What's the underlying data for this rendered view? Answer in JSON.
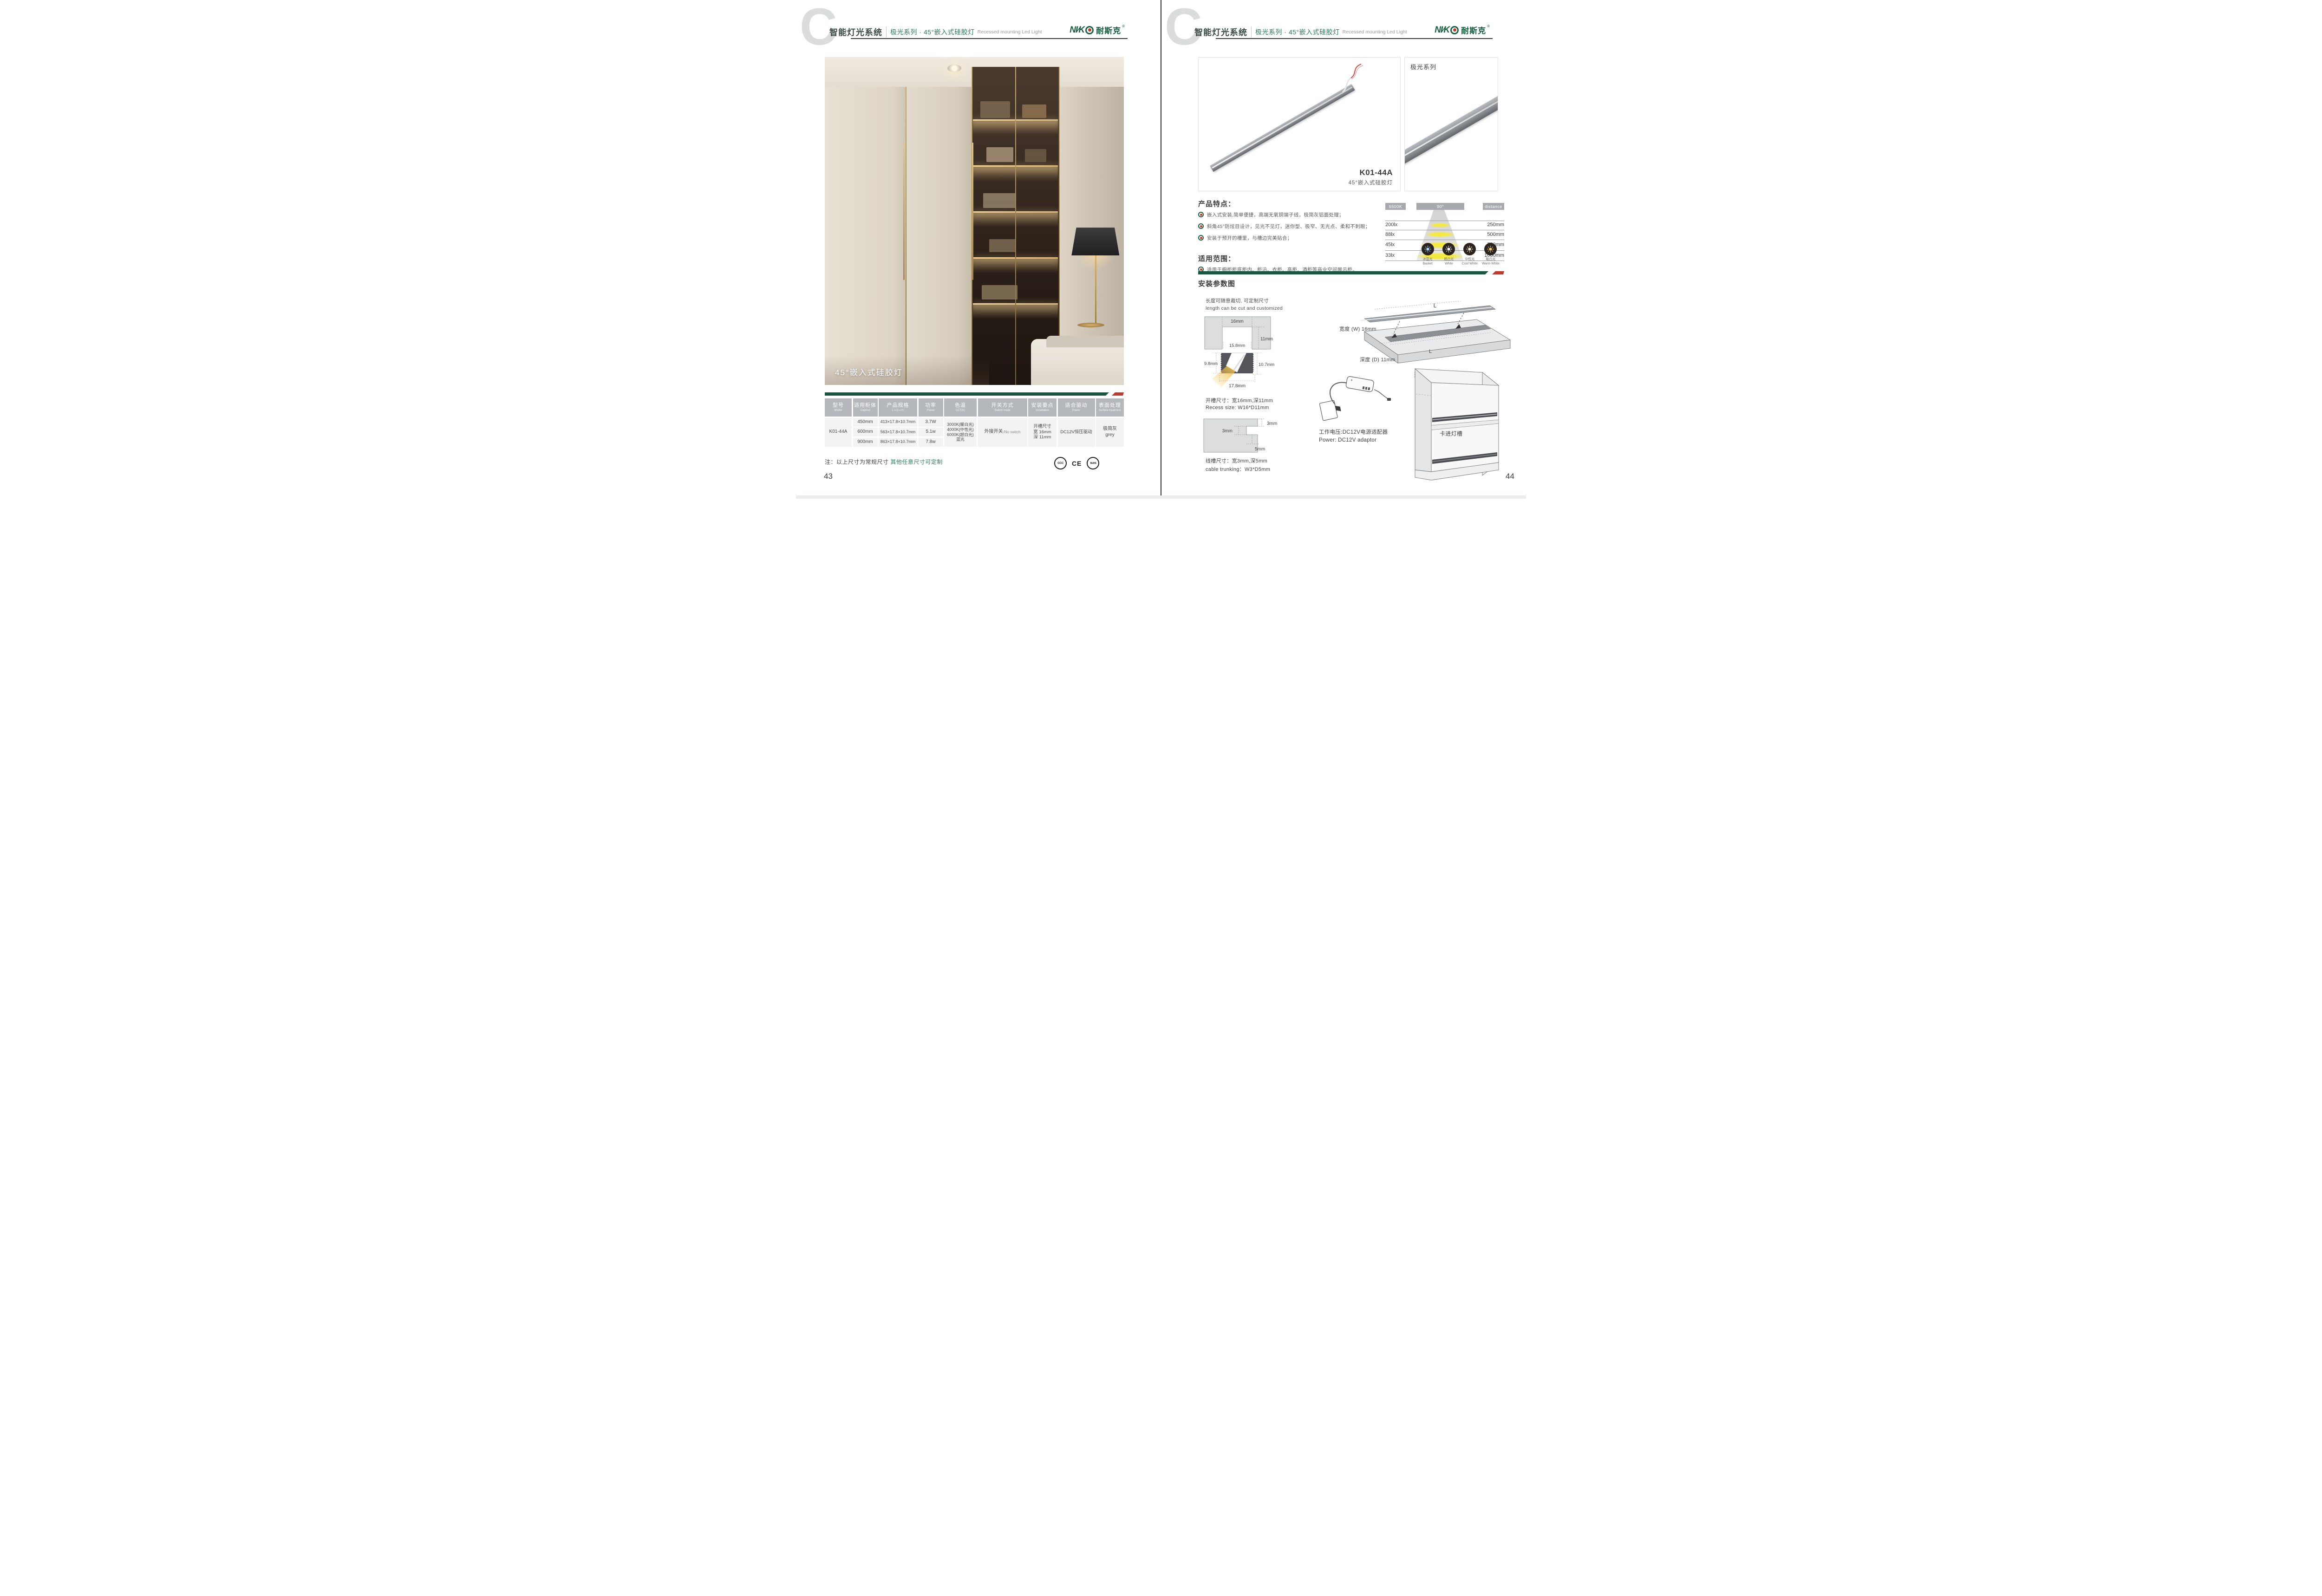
{
  "colors": {
    "accent_green": "#1b5c45",
    "note_green": "#2e7d5b",
    "accent_red": "#bf3a31",
    "badge_gray": "#a7a9ac"
  },
  "header": {
    "brand": "智能灯光系统",
    "series": "极光系列 · 45°嵌入式硅胶灯",
    "subtitle_en": "Recessed mounting Led Light",
    "logo_latin": "NI∕K",
    "logo_cn": "耐斯克",
    "logo_reg": "®"
  },
  "left_page": {
    "photo_caption": "45°嵌入式硅胶灯",
    "table": {
      "headers": [
        {
          "zh": "型号",
          "en": "Model"
        },
        {
          "zh": "适用柜体",
          "en": "Cabinet"
        },
        {
          "zh": "产品规格",
          "en": "L x D x H"
        },
        {
          "zh": "功率",
          "en": "Power"
        },
        {
          "zh": "色温",
          "en": "CCT(K)"
        },
        {
          "zh": "开关方式",
          "en": "Switch mode"
        },
        {
          "zh": "安装要点",
          "en": "Installation"
        },
        {
          "zh": "适合驱动",
          "en": "Power"
        },
        {
          "zh": "表面处理",
          "en": "Surface treatment"
        }
      ],
      "model": "K01-44A",
      "rows": [
        {
          "cabinet": "450mm",
          "spec": "413×17.8×10.7mm",
          "power": "3.7W"
        },
        {
          "cabinet": "600mm",
          "spec": "563×17.8×10.7mm",
          "power": "5.1w"
        },
        {
          "cabinet": "900mm",
          "spec": "863×17.8×10.7mm",
          "power": "7.8w"
        }
      ],
      "cct_lines": [
        "3000K(暖白光)",
        "4000K(中性光)",
        "6000K(超白光)",
        "蓝光"
      ],
      "switch_zh": "外接开关",
      "switch_en": "/No switch",
      "install_lines": [
        "开槽尺寸",
        "宽 16mm",
        "深 11mm"
      ],
      "driver": "DC12V恒压驱动",
      "surface_lines": [
        "极简灰",
        "grey"
      ]
    },
    "note_prefix": "注：以上尺寸为常规尺寸 ",
    "note_highlight": "其他任意尺寸可定制",
    "certs": [
      {
        "label": "CCC"
      },
      {
        "label": "CE"
      },
      {
        "label": "RoHS"
      }
    ],
    "page_number": "43"
  },
  "right_page": {
    "product": {
      "model": "K01-44A",
      "name": "45°嵌入式硅胶灯",
      "series_tag": "极光系列"
    },
    "features": {
      "title": "产品特点：",
      "items": [
        "嵌入式安装,简单便捷，高端无氧铜端子线，极简灰铝面处理；",
        "斜角45°防炫目设计，见光不见灯，迷你型、极窄、无光点、柔和不刺眼；",
        "安装于预开的槽里，与槽边完美贴合；"
      ]
    },
    "photometry": {
      "cct_badge": "6500K",
      "angle_badge": "90°",
      "distance_badge": "distance",
      "rows": [
        {
          "lux": "200lx",
          "distance": "250mm"
        },
        {
          "lux": "88lx",
          "distance": "500mm"
        },
        {
          "lux": "45lx",
          "distance": "750mm"
        },
        {
          "lux": "33lx",
          "distance": "1000mm"
        }
      ]
    },
    "cct_icons": [
      {
        "zh": "冰蓝光",
        "en": "Basket",
        "color": "#a9d7f2"
      },
      {
        "zh": "超白光",
        "en": "White",
        "color": "#ffffff"
      },
      {
        "zh": "中性光",
        "en": "Cool White",
        "color": "#f7ecd2"
      },
      {
        "zh": "暖白光",
        "en": "Warm White",
        "color": "#f2c96a"
      }
    ],
    "scope": {
      "title": "适用范围：",
      "items": [
        "适用于橱柜柜底柜内、柜沿、衣柜、高柜、酒柜等商业空间展示柜。"
      ]
    },
    "install": {
      "title": "安装参数图",
      "cut_note_zh": "长度可随意裁切, 可定制尺寸",
      "cut_note_en": "length can be cut and customized",
      "recess": {
        "top_width": "16mm",
        "depth": "11mm",
        "inner_width": "15.8mm",
        "left_height": "9.8mm",
        "right_height": "10.7mm",
        "bottom_width": "17.8mm",
        "size_zh": "开槽尺寸：宽16mm,深11mm",
        "size_en": "Recess size: W16*D11mm"
      },
      "trunking": {
        "step": "3mm",
        "width": "3mm",
        "depth": "5mm",
        "size_zh": "线槽尺寸：宽3mm,深5mm",
        "size_en": "cable trunking：W3*D5mm"
      },
      "board": {
        "length_top": "L",
        "length_groove": "L",
        "width_label": "宽度 (W) 16mm",
        "depth_label": "深度 (D) 11mm",
        "caption": "建议开槽尺寸"
      },
      "power_zh": "工作电压:DC12V电源适配器",
      "power_en": "Power: DC12V adaptor",
      "cabinet_label": "卡进灯槽"
    },
    "page_number": "44"
  },
  "chart_data": {
    "type": "table",
    "title": "6500K · 90° beam — illuminance vs distance",
    "columns": [
      "illuminance",
      "distance"
    ],
    "rows": [
      [
        "200lx",
        "250mm"
      ],
      [
        "88lx",
        "500mm"
      ],
      [
        "45lx",
        "750mm"
      ],
      [
        "33lx",
        "1000mm"
      ]
    ]
  }
}
